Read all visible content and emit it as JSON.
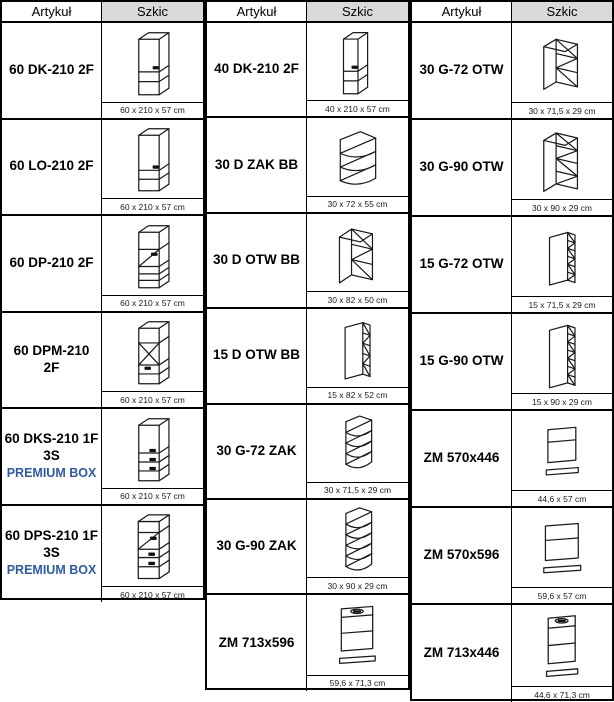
{
  "header": {
    "artykul": "Artykuł",
    "szkic": "Szkic"
  },
  "colors": {
    "premium_blue": "#2E5AA8",
    "header_gray": "#D9D9D9",
    "line_black": "#000000"
  },
  "groups": [
    {
      "rows": [
        {
          "name": "60 DK-210 2F",
          "dim": "60 x 210 x 57 cm",
          "sketch": "tall-dk"
        },
        {
          "name": "60 LO-210 2F",
          "dim": "60 x 210 x 57 cm",
          "sketch": "tall-lo"
        },
        {
          "name": "60 DP-210 2F",
          "dim": "60 x 210 x 57 cm",
          "sketch": "tall-dp"
        },
        {
          "name": "60 DPM-210 2F",
          "dim": "60 x 210 x 57 cm",
          "sketch": "tall-dpm"
        },
        {
          "name": "60 DKS-210 1F 3S",
          "premium": "PREMIUM BOX",
          "dim": "60 x 210 x 57 cm",
          "sketch": "tall-dks"
        },
        {
          "name": "60 DPS-210 1F 3S",
          "premium": "PREMIUM BOX",
          "dim": "60 x 210 x 57 cm",
          "sketch": "tall-dps"
        }
      ]
    },
    {
      "rows": [
        {
          "name": "40 DK-210 2F",
          "dim": "40 x 210 x 57 cm",
          "sketch": "tall-dk-40"
        },
        {
          "name": "30 D ZAK BB",
          "dim": "30 x 72 x 55 cm",
          "sketch": "corner-base-zak"
        },
        {
          "name": "30 D OTW BB",
          "dim": "30 x 82 x 50 cm",
          "sketch": "open-base-otw"
        },
        {
          "name": "15 D OTW BB",
          "dim": "15 x 82 x 52 cm",
          "sketch": "narrow-base-otw"
        },
        {
          "name": "30 G-72 ZAK",
          "dim": "30 x 71,5 x 29 cm",
          "sketch": "corner-wall-zak-72"
        },
        {
          "name": "30 G-90 ZAK",
          "dim": "30 x 90 x 29 cm",
          "sketch": "corner-wall-zak-90"
        },
        {
          "name": "ZM 713x596",
          "dim": "59,6 x 71,3 cm",
          "sketch": "front-panel-handle-596"
        }
      ]
    },
    {
      "rows": [
        {
          "name": "30 G-72 OTW",
          "dim": "30 x 71,5 x 29 cm",
          "sketch": "open-wall-otw-72"
        },
        {
          "name": "30 G-90 OTW",
          "dim": "30 x 90 x 29 cm",
          "sketch": "open-wall-otw-90"
        },
        {
          "name": "15 G-72 OTW",
          "dim": "15 x 71,5 x 29 cm",
          "sketch": "narrow-wall-otw-72"
        },
        {
          "name": "15 G-90 OTW",
          "dim": "15 x 90 x 29 cm",
          "sketch": "narrow-wall-otw-90"
        },
        {
          "name": "ZM 570x446",
          "dim": "44,6 x 57 cm",
          "sketch": "front-panel-446"
        },
        {
          "name": "ZM 570x596",
          "dim": "59,6 x 57 cm",
          "sketch": "front-panel-596"
        },
        {
          "name": "ZM 713x446",
          "dim": "44,6 x 71,3 cm",
          "sketch": "front-panel-handle-446"
        }
      ]
    }
  ]
}
